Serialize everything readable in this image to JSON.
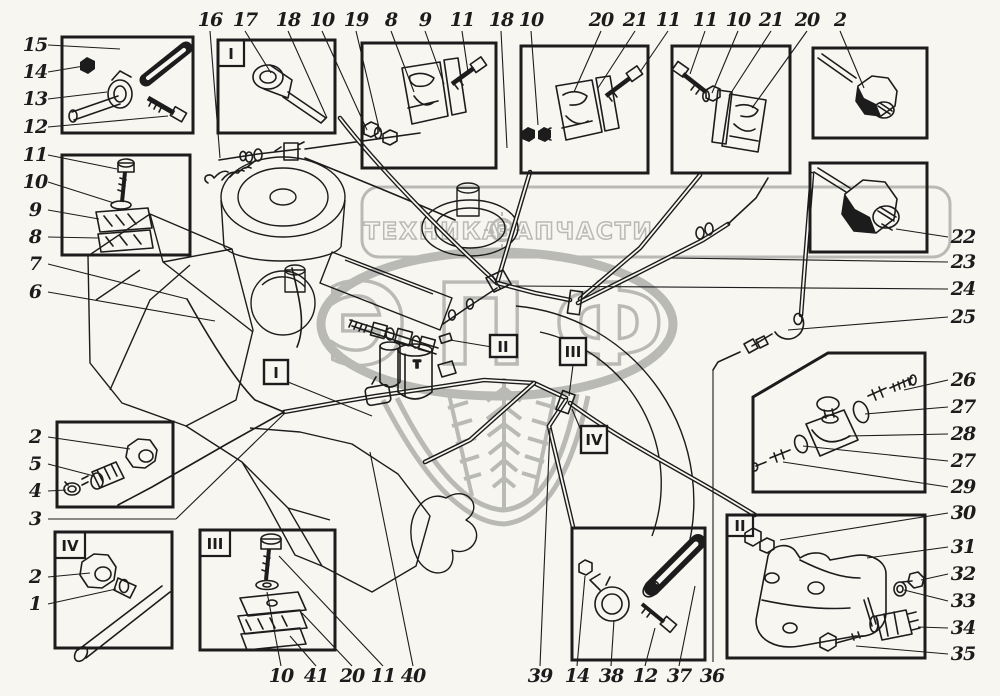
{
  "colors": {
    "ink": "#1c1c1c",
    "paper": "#f7f6f1",
    "watermark": "#b9b9b6"
  },
  "watermark": {
    "brand_left": "ТЕХНИКА",
    "brand_right": "ЗАПЧАСТИ",
    "logo": "ЭПФ"
  },
  "sections": {
    "i": "I",
    "ii": "II",
    "iii": "III",
    "iv": "IV"
  },
  "drawing": {
    "filter_mark": "Т"
  },
  "callouts": {
    "top": [
      "16",
      "17",
      "18",
      "10",
      "19",
      "8",
      "9",
      "11",
      "18",
      "10",
      "20",
      "21",
      "11",
      "11",
      "10",
      "21",
      "20",
      "2"
    ],
    "left": [
      "15",
      "14",
      "13",
      "12",
      "11",
      "10",
      "9",
      "8",
      "7",
      "6"
    ],
    "left_lower": [
      "2",
      "5",
      "4",
      "3"
    ],
    "left_iv": [
      "2",
      "1"
    ],
    "right": [
      "22",
      "23",
      "24",
      "25"
    ],
    "right_valve": [
      "26",
      "27",
      "28",
      "27",
      "29"
    ],
    "right_filter": [
      "30",
      "31",
      "32",
      "33",
      "34",
      "35"
    ],
    "bottom_iii": [
      "10",
      "41",
      "20",
      "11",
      "40"
    ],
    "bottom_j": [
      "39",
      "14",
      "38",
      "12",
      "37",
      "36"
    ]
  }
}
